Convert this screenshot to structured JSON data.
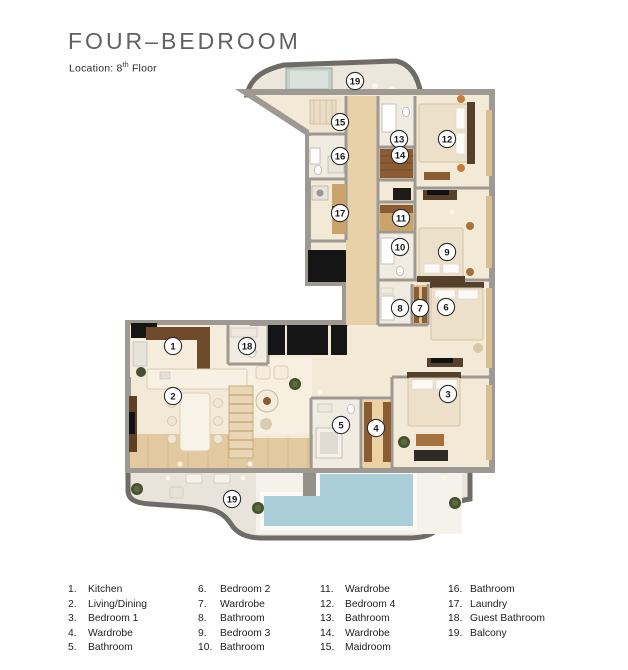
{
  "header": {
    "title": "FOUR–BEDROOM",
    "location_prefix": "Location: 8",
    "location_sup": "th",
    "location_suffix": " Floor"
  },
  "palette": {
    "wall_gray": "#9e9992",
    "floor_cream": "#f3e9d7",
    "wood_tan": "#e8d0a8",
    "balcony_edge": "#6f6b67",
    "balcony_floor": "#e9e4db",
    "pool_blue": "#abcfd8",
    "black_accent": "#151515",
    "furniture_brown": "#8a5c33",
    "headboard_brown": "#54402b",
    "marker_bg": "#ffffff",
    "marker_border": "#2b2b2b",
    "title_color": "#636160",
    "text_color": "#1e1e1e"
  },
  "floor_plan": {
    "markers": [
      {
        "n": "1",
        "x": 173,
        "y": 346
      },
      {
        "n": "2",
        "x": 173,
        "y": 396
      },
      {
        "n": "3",
        "x": 448,
        "y": 394
      },
      {
        "n": "4",
        "x": 376,
        "y": 428
      },
      {
        "n": "5",
        "x": 341,
        "y": 425
      },
      {
        "n": "6",
        "x": 446,
        "y": 307
      },
      {
        "n": "7",
        "x": 420,
        "y": 308
      },
      {
        "n": "8",
        "x": 400,
        "y": 308
      },
      {
        "n": "9",
        "x": 447,
        "y": 252
      },
      {
        "n": "10",
        "x": 400,
        "y": 247
      },
      {
        "n": "11",
        "x": 401,
        "y": 218
      },
      {
        "n": "12",
        "x": 447,
        "y": 139
      },
      {
        "n": "13",
        "x": 399,
        "y": 139
      },
      {
        "n": "14",
        "x": 400,
        "y": 155
      },
      {
        "n": "15",
        "x": 340,
        "y": 122
      },
      {
        "n": "16",
        "x": 340,
        "y": 156
      },
      {
        "n": "17",
        "x": 340,
        "y": 213
      },
      {
        "n": "18",
        "x": 247,
        "y": 346
      },
      {
        "n": "19",
        "x": 355,
        "y": 81
      },
      {
        "n": "19",
        "x": 232,
        "y": 499
      }
    ]
  },
  "legend": {
    "columns": [
      [
        {
          "num": "1.",
          "label": "Kitchen"
        },
        {
          "num": "2.",
          "label": "Living/Dining"
        },
        {
          "num": "3.",
          "label": "Bedroom 1"
        },
        {
          "num": "4.",
          "label": "Wardrobe"
        },
        {
          "num": "5.",
          "label": "Bathroom"
        }
      ],
      [
        {
          "num": "6.",
          "label": "Bedroom 2"
        },
        {
          "num": "7.",
          "label": "Wardrobe"
        },
        {
          "num": "8.",
          "label": "Bathroom"
        },
        {
          "num": "9.",
          "label": "Bedroom 3"
        },
        {
          "num": "10.",
          "label": "Bathroom"
        }
      ],
      [
        {
          "num": "11.",
          "label": "Wardrobe"
        },
        {
          "num": "12.",
          "label": "Bedroom 4"
        },
        {
          "num": "13.",
          "label": "Bathroom"
        },
        {
          "num": "14.",
          "label": "Wardrobe"
        },
        {
          "num": "15.",
          "label": "Maidroom"
        }
      ],
      [
        {
          "num": "16.",
          "label": "Bathroom"
        },
        {
          "num": "17.",
          "label": "Laundry"
        },
        {
          "num": "18.",
          "label": "Guest Bathroom"
        },
        {
          "num": "19.",
          "label": "Balcony"
        }
      ]
    ]
  }
}
